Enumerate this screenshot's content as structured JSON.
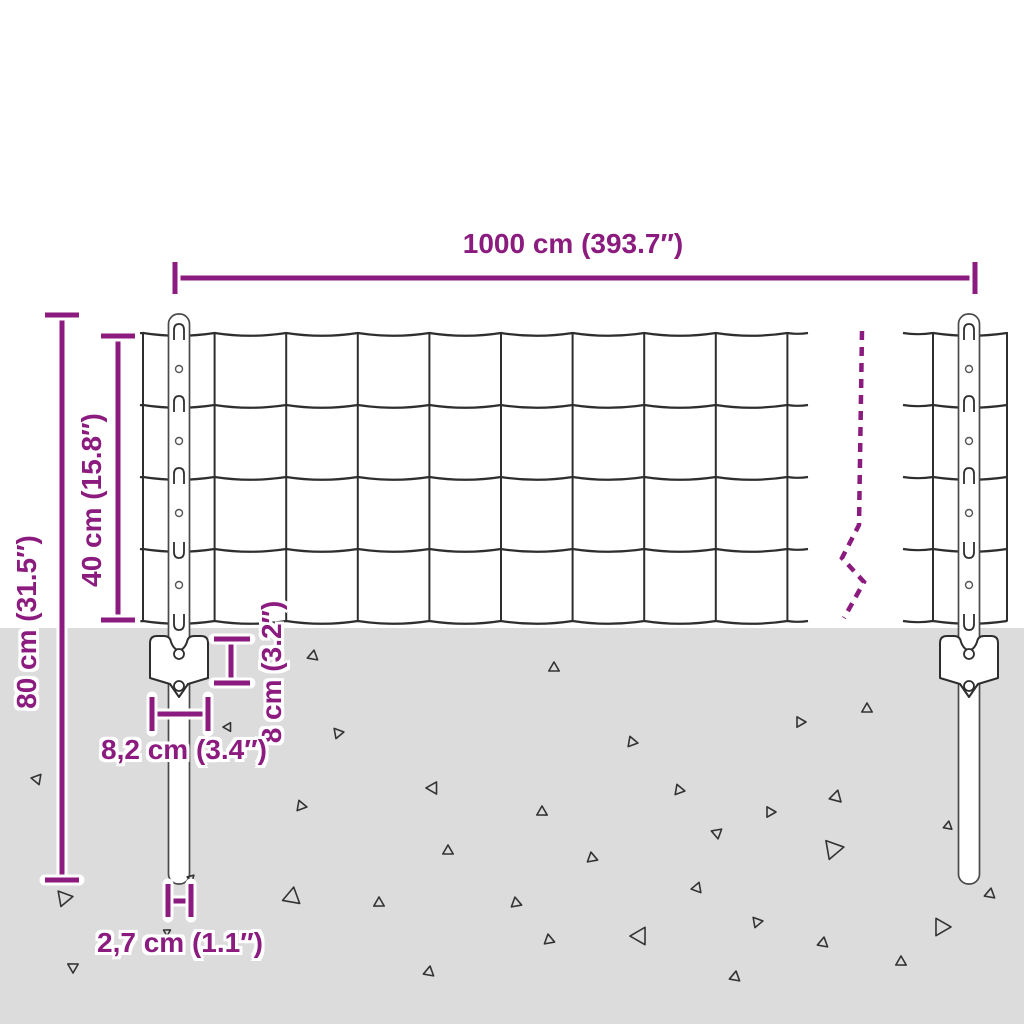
{
  "diagram": {
    "subject": "wire mesh fence with posts and ground anchor plates",
    "labels": {
      "fence_length": "1000 cm (393.7″)",
      "mesh_height": "40 cm (15.8″)",
      "post_height": "80 cm (31.5″)",
      "anchor_height": "8 cm (3.2″)",
      "anchor_width": "8,2 cm (3.4″)",
      "post_diameter": "2,7 cm (1.1″)"
    },
    "values": {
      "fence_length_cm": 1000,
      "fence_length_in": 393.7,
      "mesh_height_cm": 40,
      "mesh_height_in": 15.8,
      "post_height_cm": 80,
      "post_height_in": 31.5,
      "anchor_height_cm": 8,
      "anchor_height_in": 3.2,
      "anchor_width_cm": 8.2,
      "anchor_width_in": 3.4,
      "post_diameter_cm": 2.7,
      "post_diameter_in": 1.1
    },
    "colors": {
      "dimension_accent": "#8B1B7E",
      "ground": "#DCDCDC",
      "wire": "#2E2E2E",
      "post_outline": "#4A4A4A"
    }
  }
}
